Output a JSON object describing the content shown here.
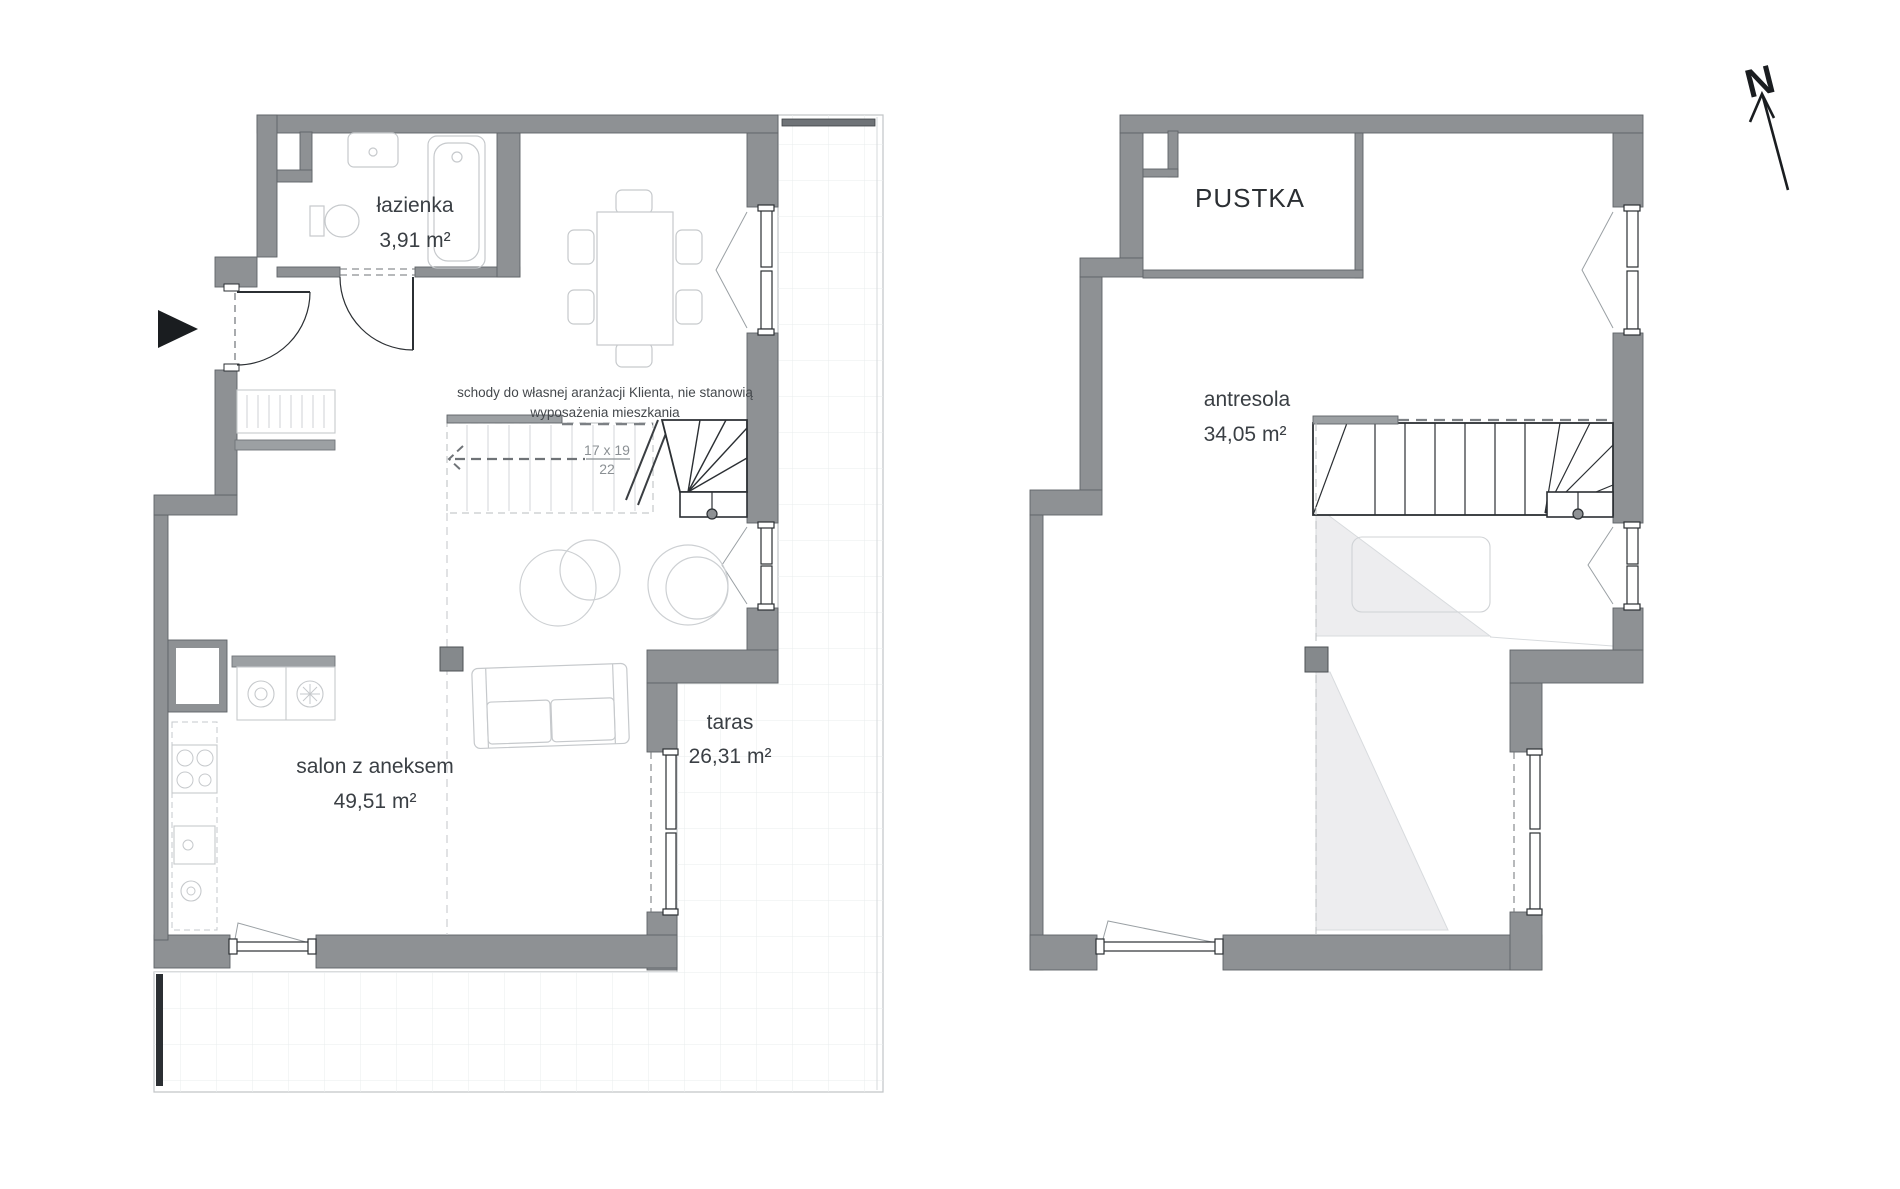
{
  "document": {
    "type": "apartment-floor-plan",
    "levels": {
      "level1": {
        "rooms": {
          "lazienka": {
            "name": "łazienka",
            "area": "3,91 m²"
          },
          "salon": {
            "name": "salon z aneksem",
            "area": "49,51 m²"
          },
          "taras": {
            "name": "taras",
            "area": "26,31 m²"
          }
        },
        "stairs_note": {
          "line1": "schody do własnej aranżacji Klienta, nie stanowią",
          "line2": "wyposażenia mieszkania"
        },
        "stairs_dims": {
          "top": "17 x 19",
          "bottom": "22"
        }
      },
      "level2": {
        "rooms": {
          "pustka": {
            "name": "PUSTKA"
          },
          "antresola": {
            "name": "antresola",
            "area": "34,05 m²"
          }
        }
      }
    },
    "compass": {
      "label": "N"
    },
    "colors": {
      "wall_fill": "#8e9194",
      "wall_stroke": "#5f6367",
      "furniture_stroke": "#c6c9cc",
      "terrace_grid": "#e9ecee",
      "void_shade": "#ededef",
      "stair_solid": "#2b2f33",
      "text": "#3a3f44",
      "dim_text": "#8b9094"
    }
  }
}
